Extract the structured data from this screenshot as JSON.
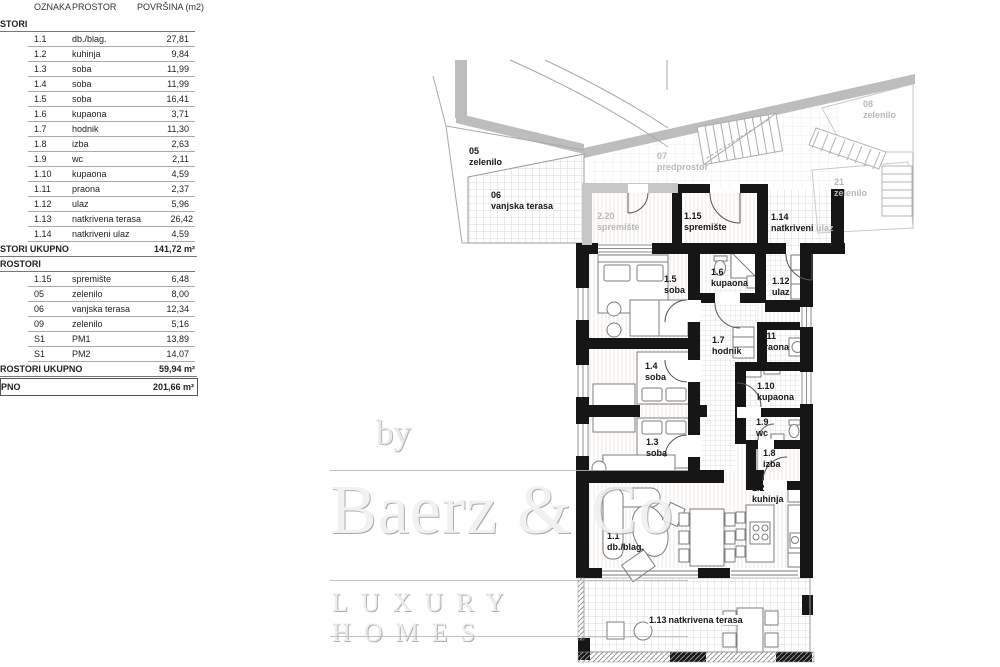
{
  "table": {
    "headers": [
      "OZNAKA",
      "PROSTOR",
      "POVRŠINA (m2)"
    ],
    "sections": [
      {
        "title": "STORI",
        "rows": [
          {
            "code": "1.1",
            "name": "db./blag.",
            "value": "27,81"
          },
          {
            "code": "1.2",
            "name": "kuhinja",
            "value": "9,84"
          },
          {
            "code": "1.3",
            "name": "soba",
            "value": "11,99"
          },
          {
            "code": "1.4",
            "name": "soba",
            "value": "11,99"
          },
          {
            "code": "1.5",
            "name": "soba",
            "value": "16,41"
          },
          {
            "code": "1.6",
            "name": "kupaona",
            "value": "3,71"
          },
          {
            "code": "1.7",
            "name": "hodnik",
            "value": "11,30"
          },
          {
            "code": "1.8",
            "name": "izba",
            "value": "2,63"
          },
          {
            "code": "1.9",
            "name": "wc",
            "value": "2,11"
          },
          {
            "code": "1.10",
            "name": "kupaona",
            "value": "4,59"
          },
          {
            "code": "1.11",
            "name": "praona",
            "value": "2,37"
          },
          {
            "code": "1.12",
            "name": "ulaz",
            "value": "5,96"
          },
          {
            "code": "1.13",
            "name": "natkrivena terasa",
            "value": "26,42"
          },
          {
            "code": "1.14",
            "name": "natkriveni ulaz",
            "value": "4,59"
          }
        ],
        "total_label": "STORI UKUPNO",
        "total_value": "141,72 m²"
      },
      {
        "title": "ROSTORI",
        "rows": [
          {
            "code": "1.15",
            "name": "spremište",
            "value": "6,48"
          },
          {
            "code": "05",
            "name": "zelenilo",
            "value": "8,00"
          },
          {
            "code": "06",
            "name": "vanjska terasa",
            "value": "12,34"
          },
          {
            "code": "09",
            "name": "zelenilo",
            "value": "5,16"
          },
          {
            "code": "S1",
            "name": "PM1",
            "value": "13,89"
          },
          {
            "code": "S1",
            "name": "PM2",
            "value": "14,07"
          }
        ],
        "total_label": "ROSTORI UKUPNO",
        "total_value": "59,94 m²"
      }
    ],
    "grand_total": {
      "label": "PNO",
      "value": "201,66 m²"
    }
  },
  "plan": {
    "labels": [
      {
        "id": "r05",
        "code": "05",
        "name": "zelenilo",
        "tone": "dark"
      },
      {
        "id": "r06",
        "code": "06",
        "name": "vanjska terasa",
        "tone": "dark"
      },
      {
        "id": "r07",
        "code": "07",
        "name": "predprostor",
        "tone": "gray"
      },
      {
        "id": "r220",
        "code": "2.20",
        "name": "spremište",
        "tone": "gray"
      },
      {
        "id": "r115",
        "code": "1.15",
        "name": "spremište",
        "tone": "dark"
      },
      {
        "id": "r114",
        "code": "1.14",
        "name": "natkriveni",
        "name2": "ulaz",
        "tone": "dark"
      },
      {
        "id": "r08",
        "code": "08",
        "name": "zelenilo",
        "tone": "gray"
      },
      {
        "id": "r21",
        "code": "21",
        "name": "zelenilo",
        "tone": "gray"
      },
      {
        "id": "r15",
        "code": "1.5",
        "name": "soba",
        "tone": "dark"
      },
      {
        "id": "r16",
        "code": "1.6",
        "name": "kupaona",
        "tone": "dark"
      },
      {
        "id": "r112",
        "code": "1.12",
        "name": "ulaz",
        "tone": "dark"
      },
      {
        "id": "r17",
        "code": "1.7",
        "name": "hodnik",
        "tone": "dark"
      },
      {
        "id": "r111",
        "code": "1.11",
        "name": "praona",
        "tone": "dark"
      },
      {
        "id": "r14",
        "code": "1.4",
        "name": "soba",
        "tone": "dark"
      },
      {
        "id": "r110",
        "code": "1.10",
        "name": "kupaona",
        "tone": "dark"
      },
      {
        "id": "r19",
        "code": "1.9",
        "name": "wc",
        "tone": "dark"
      },
      {
        "id": "r18",
        "code": "1.8",
        "name": "izba",
        "tone": "dark"
      },
      {
        "id": "r13",
        "code": "1.3",
        "name": "soba",
        "tone": "dark"
      },
      {
        "id": "r12",
        "code": "1.2",
        "name": "kuhinja",
        "tone": "dark"
      },
      {
        "id": "r11",
        "code": "1.1",
        "name": "db./blag.",
        "tone": "dark"
      },
      {
        "id": "r113",
        "code": "1.13",
        "name": "natkrivena terasa",
        "tone": "dark"
      }
    ]
  },
  "watermark": {
    "byline": "by",
    "brand": "Baerz & Co",
    "tagline": "LUXURY HOMES"
  }
}
